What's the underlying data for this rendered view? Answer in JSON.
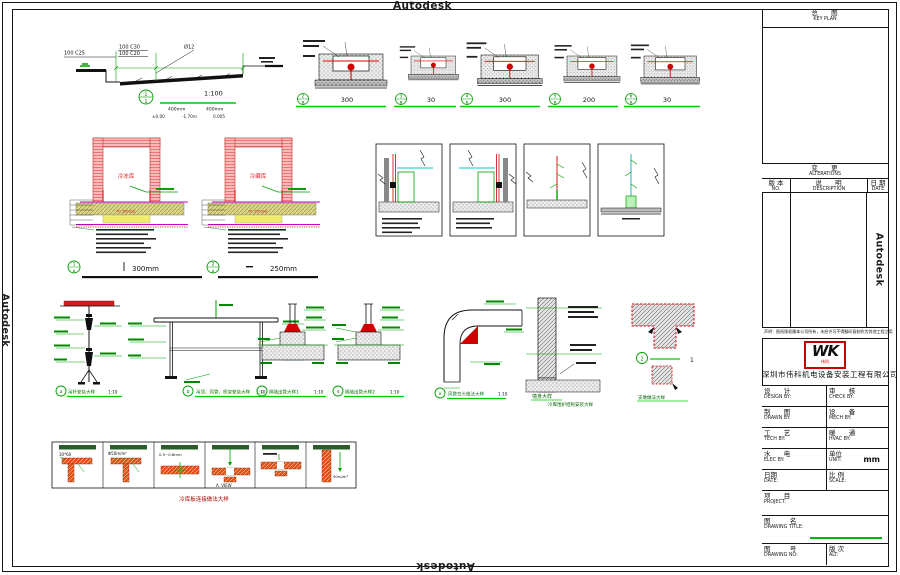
{
  "watermark": {
    "text": "Autodesk"
  },
  "titleblock": {
    "keyplan_cn": "总    图",
    "keyplan_en": "KEY PLAN",
    "alt_cn": "变    更",
    "alt_en": "ALTERATIONS",
    "no_cn": "版 本",
    "no_en": "NO.",
    "desc_cn": "说    明",
    "desc_en": "DESCRIPTION",
    "date_cn": "日 期",
    "date_en": "DATE",
    "disclaimer": "声明：图纸版权属本公司所有，未经许可不得翻印复制作为其他工程之用",
    "logo": "WK",
    "logo_sub": "伟科",
    "company": "深圳市伟科机电设备安装工程有限公司",
    "design_cn": "设    计",
    "design_en": "DESIGN BY:",
    "check_cn": "审    核",
    "check_en": "CHECK BY:",
    "drawn_cn": "制    图",
    "drawn_en": "DRAWN BY:",
    "mech_cn": "设    备",
    "mech_en": "MECH BY:",
    "tech_cn": "工    艺",
    "tech_en": "TECH BY:",
    "hvac_cn": "暖    通",
    "hvac_en": "HVAC BY:",
    "elec_cn": "水    电",
    "elec_en": "ELEC BY:",
    "unit_cn": "单位",
    "unit_en": "UNIT:",
    "unit_value": "mm",
    "date2_cn": "日期",
    "date2_en": "DATE:",
    "scale_cn": "比 例",
    "scale_en": "SCALE:",
    "project_cn": "项    目",
    "project_en": "PROJECT:",
    "title_cn": "图      名",
    "title_en": "DRAWING TITLE:",
    "no2_cn": "图      号",
    "no2_en": "DRAWING NO:",
    "altver_cn": "版 次",
    "altver_en": "ALT:"
  },
  "ramp": {
    "l1": "100  C25",
    "l2": "100  C30",
    "l3": "100  C20",
    "rebar": "Ø12",
    "marker_no": "1",
    "marker_ref": "1",
    "scale": "1:100",
    "dim1": "400mm",
    "dim2": "400mm",
    "lv1": "±0.00",
    "lv2": "-1.70m",
    "lv3": "0.005"
  },
  "trench": [
    {
      "no": "2",
      "ref": "B",
      "dim": "300"
    },
    {
      "no": "3",
      "ref": "B",
      "dim": "30"
    },
    {
      "no": "4",
      "ref": "B",
      "dim": "300"
    },
    {
      "no": "5",
      "ref": "B",
      "dim": "200"
    },
    {
      "no": "6",
      "ref": "B",
      "dim": "30"
    }
  ],
  "cold": [
    {
      "name": "冷冻库",
      "slab": "PC 3500psi",
      "no": "1",
      "ref": "A",
      "dim": "300mm"
    },
    {
      "name": "冷藏库",
      "slab": "PC 3500psi",
      "no": "2",
      "ref": "A",
      "dim": "250mm"
    }
  ],
  "details": {
    "a_letter": "a",
    "a_caption": "吊杆安装大样",
    "a_scale": "1:10",
    "b_letter": "b",
    "b_caption": "吊顶、风管、桥架安装大样",
    "b_scale": "1:10",
    "c_letter": "c",
    "c_caption": "隔墙出管大样1",
    "c_scale": "1:10",
    "d_letter": "d",
    "d_caption": "隔墙出管大样2",
    "d_scale": "1:10",
    "e_letter": "e",
    "e_caption": "风管弯头做法大样",
    "e_scale": "1:10",
    "wall1": "墙身大样",
    "wall2": "冷库围护结构安装大样",
    "t_no": "2",
    "t_after": "1",
    "t_caption": "支墩做法大样"
  },
  "panels": {
    "caption": "冷库板连接做法大样",
    "cells": [
      {
        "label": "30*60"
      },
      {
        "label": "Φ50m/m²"
      },
      {
        "label": "0.5~0.8mm"
      },
      {
        "label": "A. VIEW"
      },
      {
        "label": ""
      },
      {
        "label": "50m/m³"
      }
    ]
  }
}
